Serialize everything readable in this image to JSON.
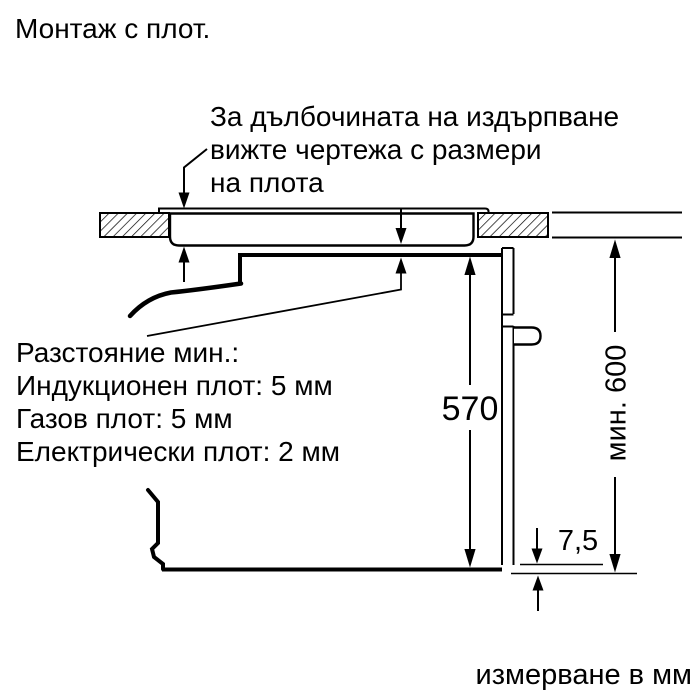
{
  "title": "Монтаж с плот.",
  "annotation": {
    "line1": "За дълбочината на издърпване",
    "line2": "вижте чертежа с размери",
    "line3": "на плота"
  },
  "clearance_note": {
    "line1": "Разстояние мин.:",
    "line2": "Индукционен плот: 5 мм",
    "line3": "Газов плот: 5 мм",
    "line4": "Електрически плот: 2 мм"
  },
  "dimensions": {
    "oven_height_mm": "570",
    "bottom_gap_mm": "7,5",
    "min_niche_height": "мин. 600"
  },
  "footer_note": "измерване в мм",
  "colors": {
    "line": "#000000",
    "background": "#ffffff",
    "text": "#000000"
  }
}
